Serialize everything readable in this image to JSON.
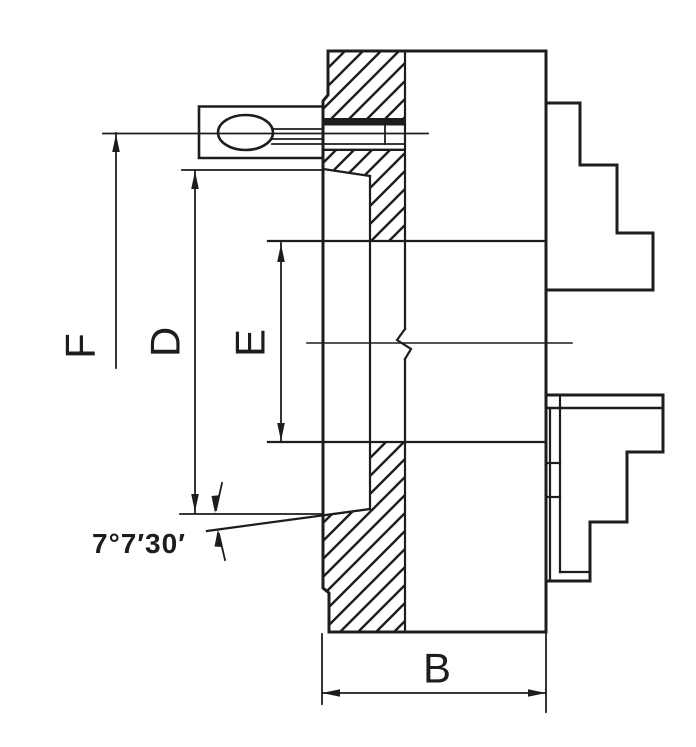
{
  "drawing": {
    "labels": {
      "f": "F",
      "d": "D",
      "e": "E",
      "b": "B",
      "taper_angle": "7°7′30′"
    },
    "colors": {
      "line": "#1d1d1b",
      "background": "#ffffff"
    }
  }
}
